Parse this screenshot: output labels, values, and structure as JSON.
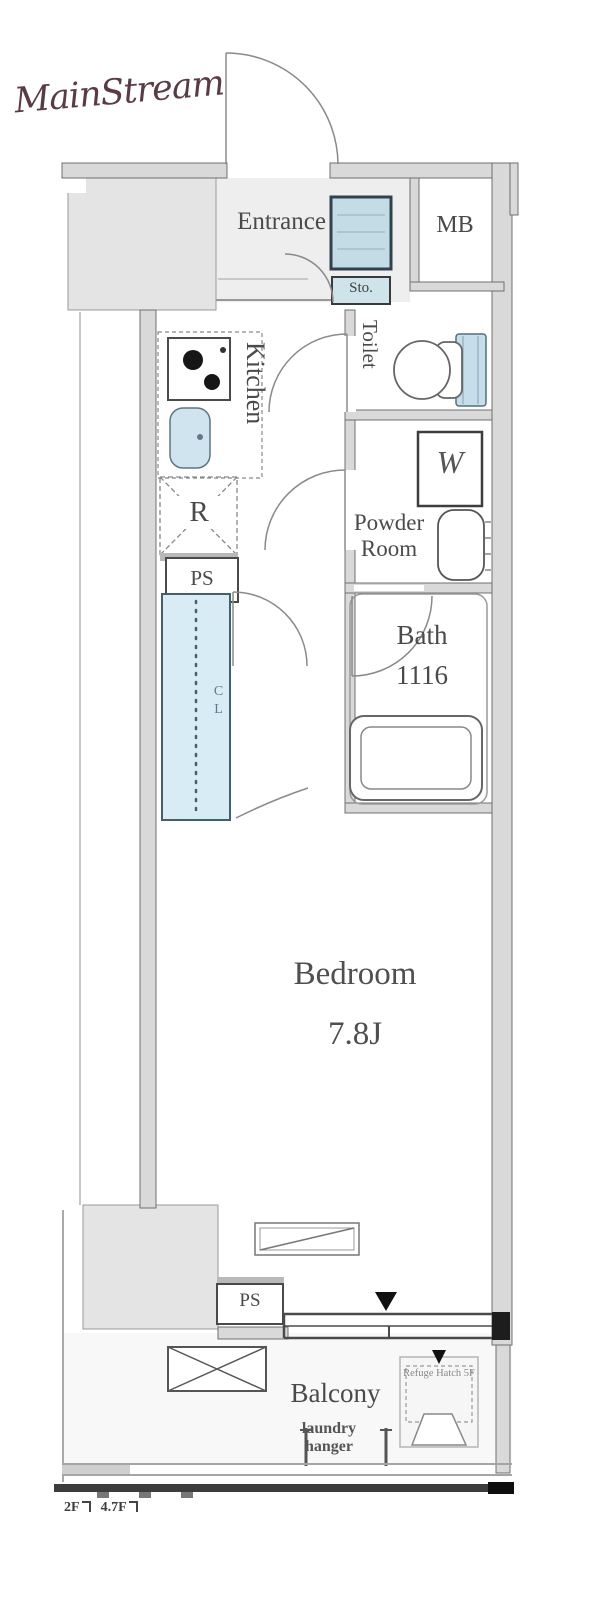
{
  "logo": {
    "brand": "MainStream"
  },
  "labels": {
    "entrance": "Entrance",
    "mb": "MB",
    "sto": "Sto.",
    "kitchen": "Kitchen",
    "toilet": "Toilet",
    "washer": "W",
    "powder_room": "Powder Room",
    "bath": "Bath",
    "bath_size": "1116",
    "fridge": "R",
    "pipe_space_upper": "PS",
    "closet": "CL",
    "bedroom": "Bedroom",
    "bedroom_size": "7.8J",
    "balcony": "Balcony",
    "laundry_hanger": "laundry hanger",
    "pipe_space_lower": "PS",
    "refuge_hatch": "Refuge Hatch 5F",
    "level_left": "2F",
    "level_right": "4.7F"
  },
  "colors": {
    "logo": "#5a3a45",
    "fixture_blue": "#cfe4ee",
    "closet_blue": "#d8ecf5",
    "wall_gray": "#d9d9d9",
    "line": "#555555"
  }
}
